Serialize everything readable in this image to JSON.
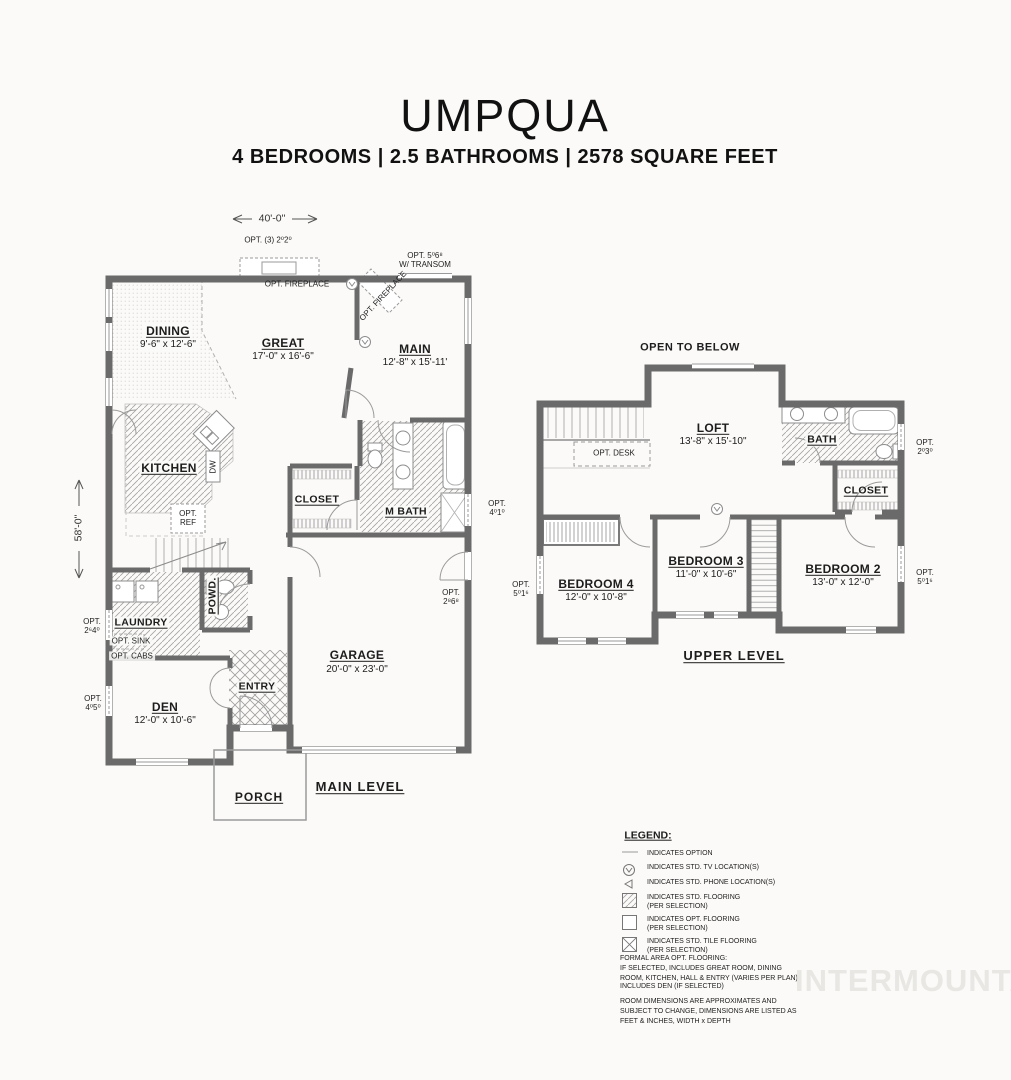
{
  "page": {
    "title": "UMPQUA",
    "subtitle": "4 BEDROOMS | 2.5 BATHROOMS | 2578 SQUARE FEET",
    "watermark": "INTERMOUNTAIN"
  },
  "main_level": {
    "level_label": "MAIN LEVEL",
    "overall_width": "40'-0\"",
    "overall_depth": "58'-0\"",
    "rooms": {
      "dining": {
        "name": "DINING",
        "dims": "9'-6\" x 12'-6\""
      },
      "great": {
        "name": "GREAT",
        "dims": "17'-0\" x 16'-6\""
      },
      "main": {
        "name": "MAIN",
        "dims": "12'-8\" x 15'-11'"
      },
      "kitchen": {
        "name": "KITCHEN"
      },
      "closet": {
        "name": "CLOSET"
      },
      "mbath": {
        "name": "M BATH"
      },
      "powder": {
        "name": "POWD."
      },
      "laundry": {
        "name": "LAUNDRY"
      },
      "entry": {
        "name": "ENTRY"
      },
      "den": {
        "name": "DEN",
        "dims": "12'-0\" x 10'-6\""
      },
      "garage": {
        "name": "GARAGE",
        "dims": "20'-0\" x 23'-0\""
      },
      "porch": {
        "name": "PORCH"
      }
    },
    "labels": {
      "dw": "DW",
      "opt_ref_l1": "OPT.",
      "opt_ref_l2": "REF",
      "opt_sink": "OPT. SINK",
      "opt_cabs": "OPT. CABS",
      "opt_windows_top": "OPT. (3) 2⁰2⁰",
      "opt_fireplace_great": "OPT. FIREPLACE",
      "opt_door_transom_l1": "OPT. 5⁰6⁸",
      "opt_door_transom_l2": "W/ TRANSOM",
      "opt_fireplace_main": "OPT. FIREPLACE",
      "opt_win_mbath_l1": "OPT.",
      "opt_win_mbath_l2": "4⁰1⁰",
      "opt_door_garage_l1": "OPT.",
      "opt_door_garage_l2": "2⁸6⁸",
      "opt_win_laundry_l1": "OPT.",
      "opt_win_laundry_l2": "2⁶4⁰",
      "opt_win_den_l1": "OPT.",
      "opt_win_den_l2": "4⁰5⁰"
    }
  },
  "upper_level": {
    "level_label": "UPPER LEVEL",
    "open_to_below": "OPEN TO BELOW",
    "rooms": {
      "loft": {
        "name": "LOFT",
        "dims": "13'-8\" x 15'-10\""
      },
      "bath": {
        "name": "BATH"
      },
      "closet": {
        "name": "CLOSET"
      },
      "bedroom4": {
        "name": "BEDROOM 4",
        "dims": "12'-0\" x 10'-8\""
      },
      "bedroom3": {
        "name": "BEDROOM 3",
        "dims": "11'-0\" x 10'-6\""
      },
      "bedroom2": {
        "name": "BEDROOM 2",
        "dims": "13'-0\" x 12'-0\""
      }
    },
    "labels": {
      "opt_desk": "OPT. DESK",
      "opt_win_bath_l1": "OPT.",
      "opt_win_bath_l2": "2⁰3⁰",
      "opt_win_left_l1": "OPT.",
      "opt_win_left_l2": "5⁰1⁶",
      "opt_win_right_l1": "OPT.",
      "opt_win_right_l2": "5⁰1⁶"
    }
  },
  "legend": {
    "title": "LEGEND:",
    "items": [
      {
        "icon": "dash-icon",
        "line1": "INDICATES OPTION",
        "line2": ""
      },
      {
        "icon": "tv-icon",
        "line1": "INDICATES STD. TV LOCATION(S)",
        "line2": ""
      },
      {
        "icon": "phone-icon",
        "line1": "INDICATES STD. PHONE LOCATION(S)",
        "line2": ""
      },
      {
        "icon": "std-flooring-icon",
        "line1": "INDICATES STD. FLOORING",
        "line2": "(PER SELECTION)"
      },
      {
        "icon": "opt-flooring-icon",
        "line1": "INDICATES OPT. FLOORING",
        "line2": "(PER SELECTION)"
      },
      {
        "icon": "tile-flooring-icon",
        "line1": "INDICATES STD. TILE FLOORING",
        "line2": "(PER SELECTION)"
      }
    ],
    "notes": [
      "FORMAL AREA OPT. FLOORING:\nIF SELECTED, INCLUDES GREAT ROOM, DINING\nROOM, KITCHEN, HALL & ENTRY (VARIES PER PLAN)",
      "INCLUDES DEN (IF SELECTED)",
      "ROOM DIMENSIONS ARE APPROXIMATES AND\nSUBJECT TO CHANGE, DIMENSIONS ARE LISTED AS\nFEET & INCHES, WIDTH x DEPTH"
    ]
  },
  "colors": {
    "wall": "#6a6a6a",
    "watermark": "#e8e7e3",
    "background": "#fbfaf8"
  }
}
